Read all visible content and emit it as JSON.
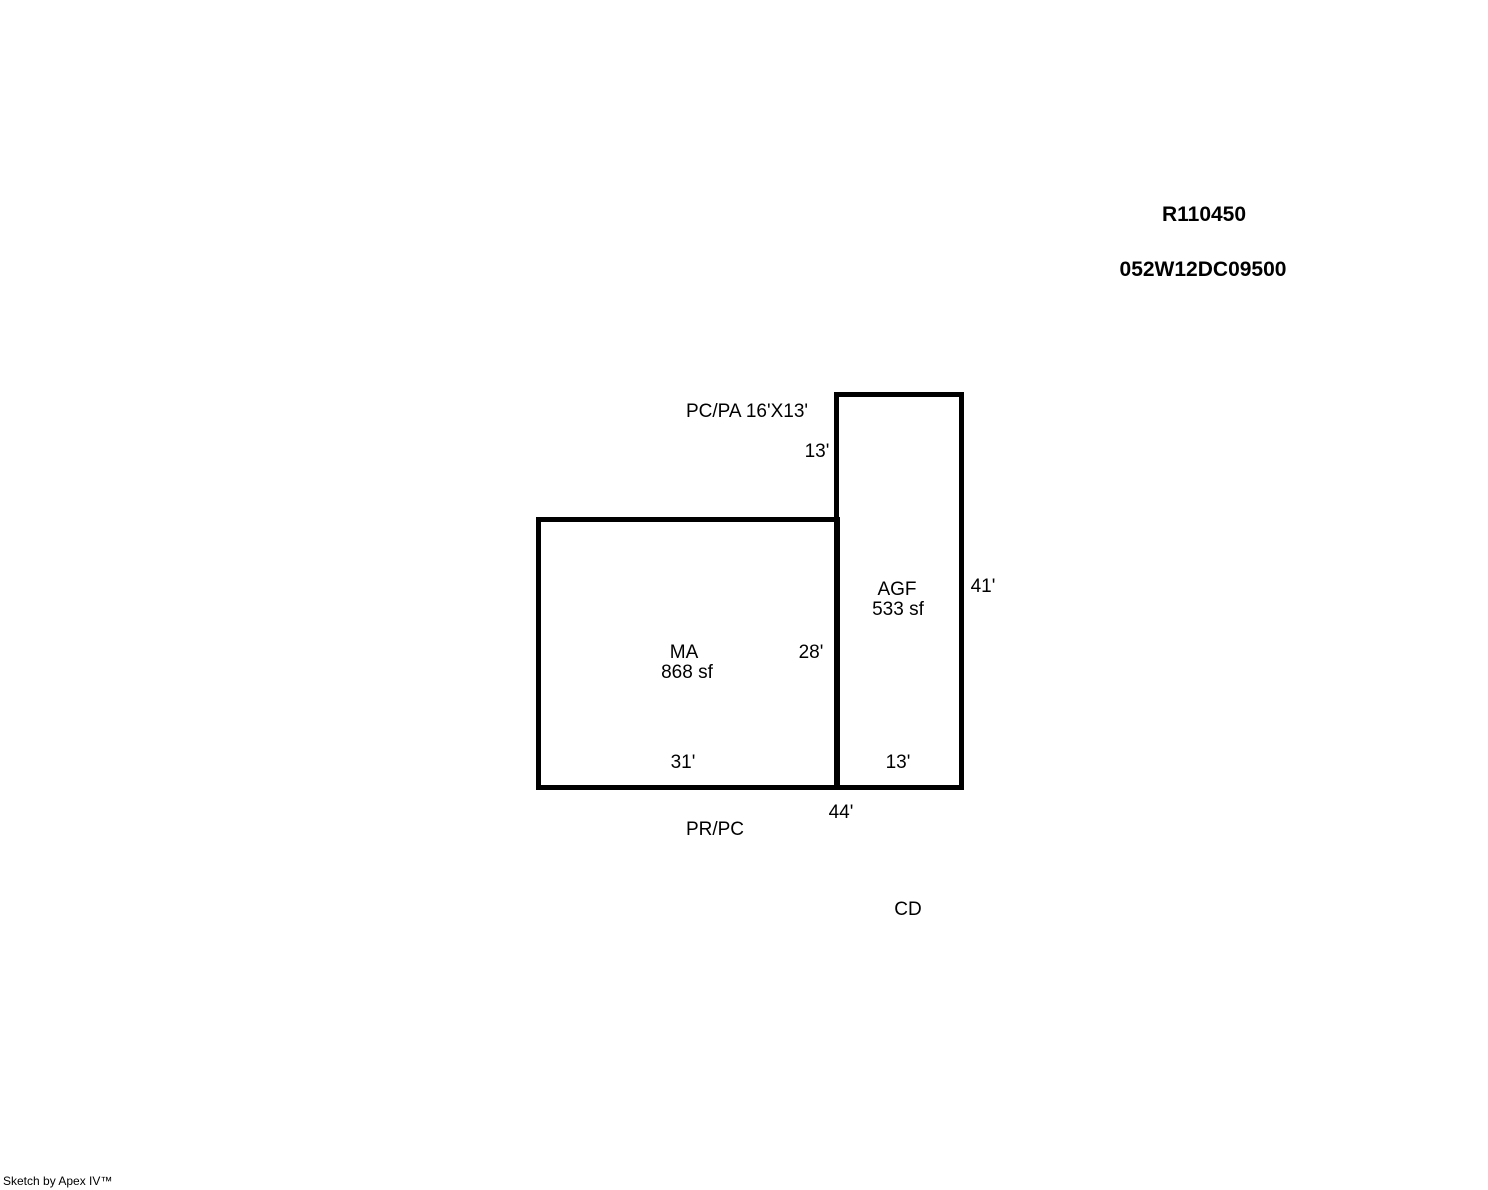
{
  "page": {
    "record_number": "R110450",
    "parcel_number": "052W12DC09500"
  },
  "sketch": {
    "porch_label": "PC/PA 16'X13'",
    "ma": {
      "code": "MA",
      "area": "868 sf",
      "right_dim": "28'",
      "bottom_dim": "31'"
    },
    "agf": {
      "code": "AGF",
      "area": "533 sf",
      "top_dim": "13'",
      "right_dim": "41'",
      "bottom_dim": "13'"
    },
    "total_bottom_dim": "44'",
    "rear_porch_label": "PR/PC",
    "deck_label": "CD"
  },
  "footer": {
    "credit": "Sketch by Apex IV™"
  }
}
